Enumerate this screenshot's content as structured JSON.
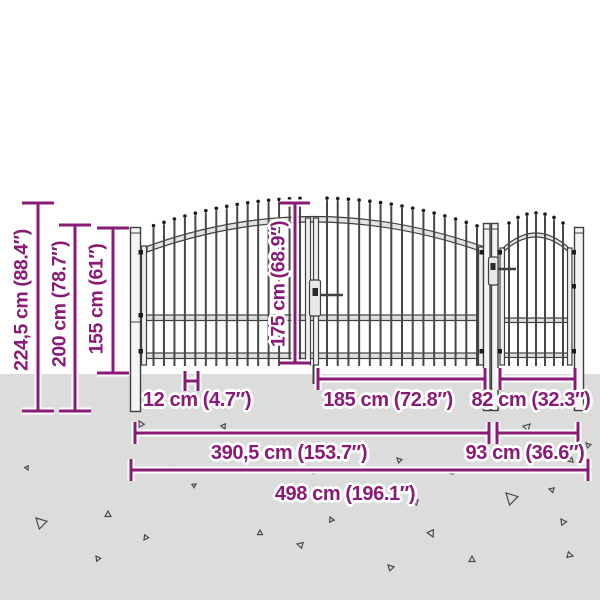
{
  "diagram": {
    "type": "product dimension drawing",
    "subject": "garden fence double gate with wicket, spear-top pickets",
    "colors": {
      "annotation": "#8a1b75",
      "ground": "#dcdcdc",
      "linework": "#3f3f3f"
    },
    "labels": {
      "height_total": "224,5 cm (88.4″)",
      "height_200": "200 cm (78.7″)",
      "height_155": "155 cm (61″)",
      "height_gate": "175 cm (68.9″)",
      "picket_spacing": "12 cm (4.7″)",
      "leaf_width": "185 cm (72.8″)",
      "wicket_leaf_width": "82 cm (32.3″)",
      "double_gate_width": "390,5 cm (153.7″)",
      "wicket_gate_width": "93 cm (36.6″)",
      "total_width": "498 cm (196.1″)"
    }
  }
}
